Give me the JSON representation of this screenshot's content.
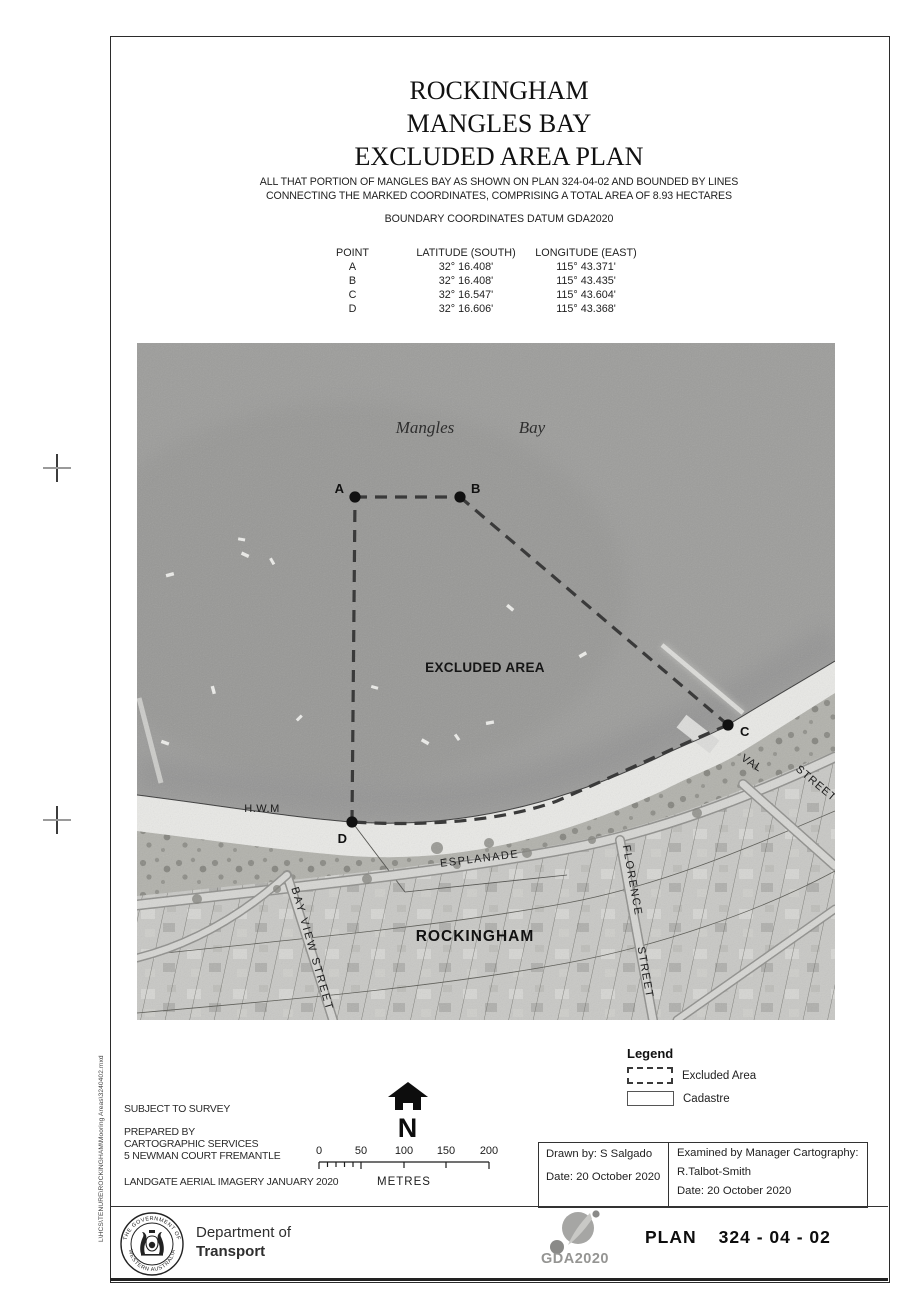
{
  "page": {
    "title_lines": [
      "ROCKINGHAM",
      "MANGLES BAY",
      "EXCLUDED AREA PLAN"
    ],
    "description_line1": "ALL THAT PORTION OF MANGLES BAY AS SHOWN ON PLAN 324-04-02 AND BOUNDED BY LINES",
    "description_line2": "CONNECTING THE MARKED COORDINATES, COMPRISING A TOTAL AREA OF 8.93 HECTARES",
    "datum_note": "BOUNDARY COORDINATES DATUM GDA2020",
    "file_path": "L\\HCS\\TENURE\\ROCKINGHAM\\Mooring Areas\\3240402.mxd"
  },
  "coordinates_table": {
    "headers": [
      "POINT",
      "LATITUDE (SOUTH)",
      "LONGITUDE (EAST)"
    ],
    "rows": [
      {
        "point": "A",
        "lat": "32° 16.408'",
        "lon": "115° 43.371'"
      },
      {
        "point": "B",
        "lat": "32° 16.408'",
        "lon": "115° 43.435'"
      },
      {
        "point": "C",
        "lat": "32° 16.547'",
        "lon": "115° 43.604'"
      },
      {
        "point": "D",
        "lat": "32° 16.606'",
        "lon": "115° 43.368'"
      }
    ]
  },
  "map": {
    "water_name_1": "Mangles",
    "water_name_2": "Bay",
    "area_label": "EXCLUDED AREA",
    "hwm_label": "H.W.M",
    "locality_label": "ROCKINGHAM",
    "streets": {
      "esplanade": "ESPLANADE",
      "bay_view": "BAY VIEW STREET",
      "florence": "FLORENCE",
      "florence_street": "STREET",
      "val": "VAL",
      "val_street": "STREET"
    },
    "points": {
      "a": "A",
      "b": "B",
      "c": "C",
      "d": "D"
    },
    "colors": {
      "water": "#9c9c9a",
      "sand": "#e9e9e6",
      "scrub": "#b1b1ab",
      "urban": "#c8c8c5",
      "boundary": "#3a3a3a"
    }
  },
  "legend": {
    "title": "Legend",
    "items": [
      {
        "label": "Excluded Area"
      },
      {
        "label": "Cadastre"
      }
    ]
  },
  "notes": {
    "subject": "SUBJECT TO SURVEY",
    "prepared_1": "PREPARED BY",
    "prepared_2": "CARTOGRAPHIC SERVICES",
    "prepared_3": "5 NEWMAN COURT FREMANTLE",
    "imagery": "LANDGATE AERIAL IMAGERY JANUARY 2020"
  },
  "north": {
    "letter": "N"
  },
  "scale_bar": {
    "ticks": [
      "0",
      "50",
      "100",
      "150",
      "200"
    ],
    "unit": "METRES"
  },
  "title_block": {
    "drawn_by": "Drawn by: S Salgado",
    "drawn_date": "Date: 20 October 2020",
    "examined_by": "Examined by Manager Cartography:",
    "examiner": "R.Talbot-Smith",
    "examined_date": "Date: 20 October 2020"
  },
  "footer": {
    "crest_top": "THE GOVERNMENT OF",
    "crest_bottom": "WESTERN AUSTRALIA",
    "dept_line1": "Department of",
    "dept_line2": "Transport",
    "gda_logo": "GDA2020",
    "plan_label": "PLAN",
    "plan_number": "324 - 04 - 02"
  }
}
